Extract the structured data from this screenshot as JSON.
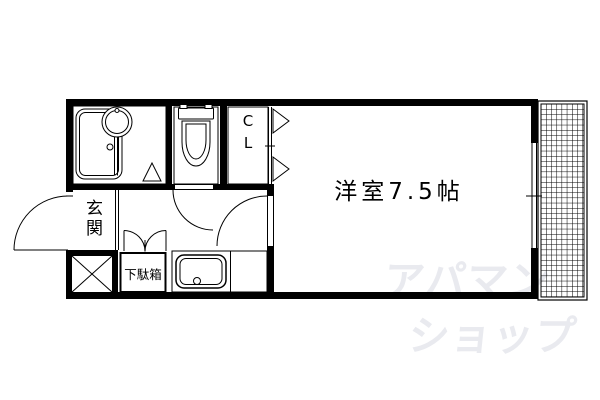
{
  "floorplan": {
    "background_color": "#ffffff",
    "line_color": "#000000",
    "labels": {
      "main_room": "洋室7.5帖",
      "entrance": "玄関",
      "shoe_cabinet": "下駄箱",
      "closet": "CL"
    },
    "fixtures": [
      "bathtub",
      "washbasin",
      "toilet",
      "kitchen-sink",
      "shoe-cabinet",
      "closet",
      "balcony-hatch",
      "entrance-door",
      "room-door",
      "toilet-door",
      "folding-doors",
      "window",
      "utility-cross-box"
    ],
    "watermark": {
      "line1": "アパマン",
      "line2": "ショップ",
      "color": "#e9eaef"
    }
  }
}
